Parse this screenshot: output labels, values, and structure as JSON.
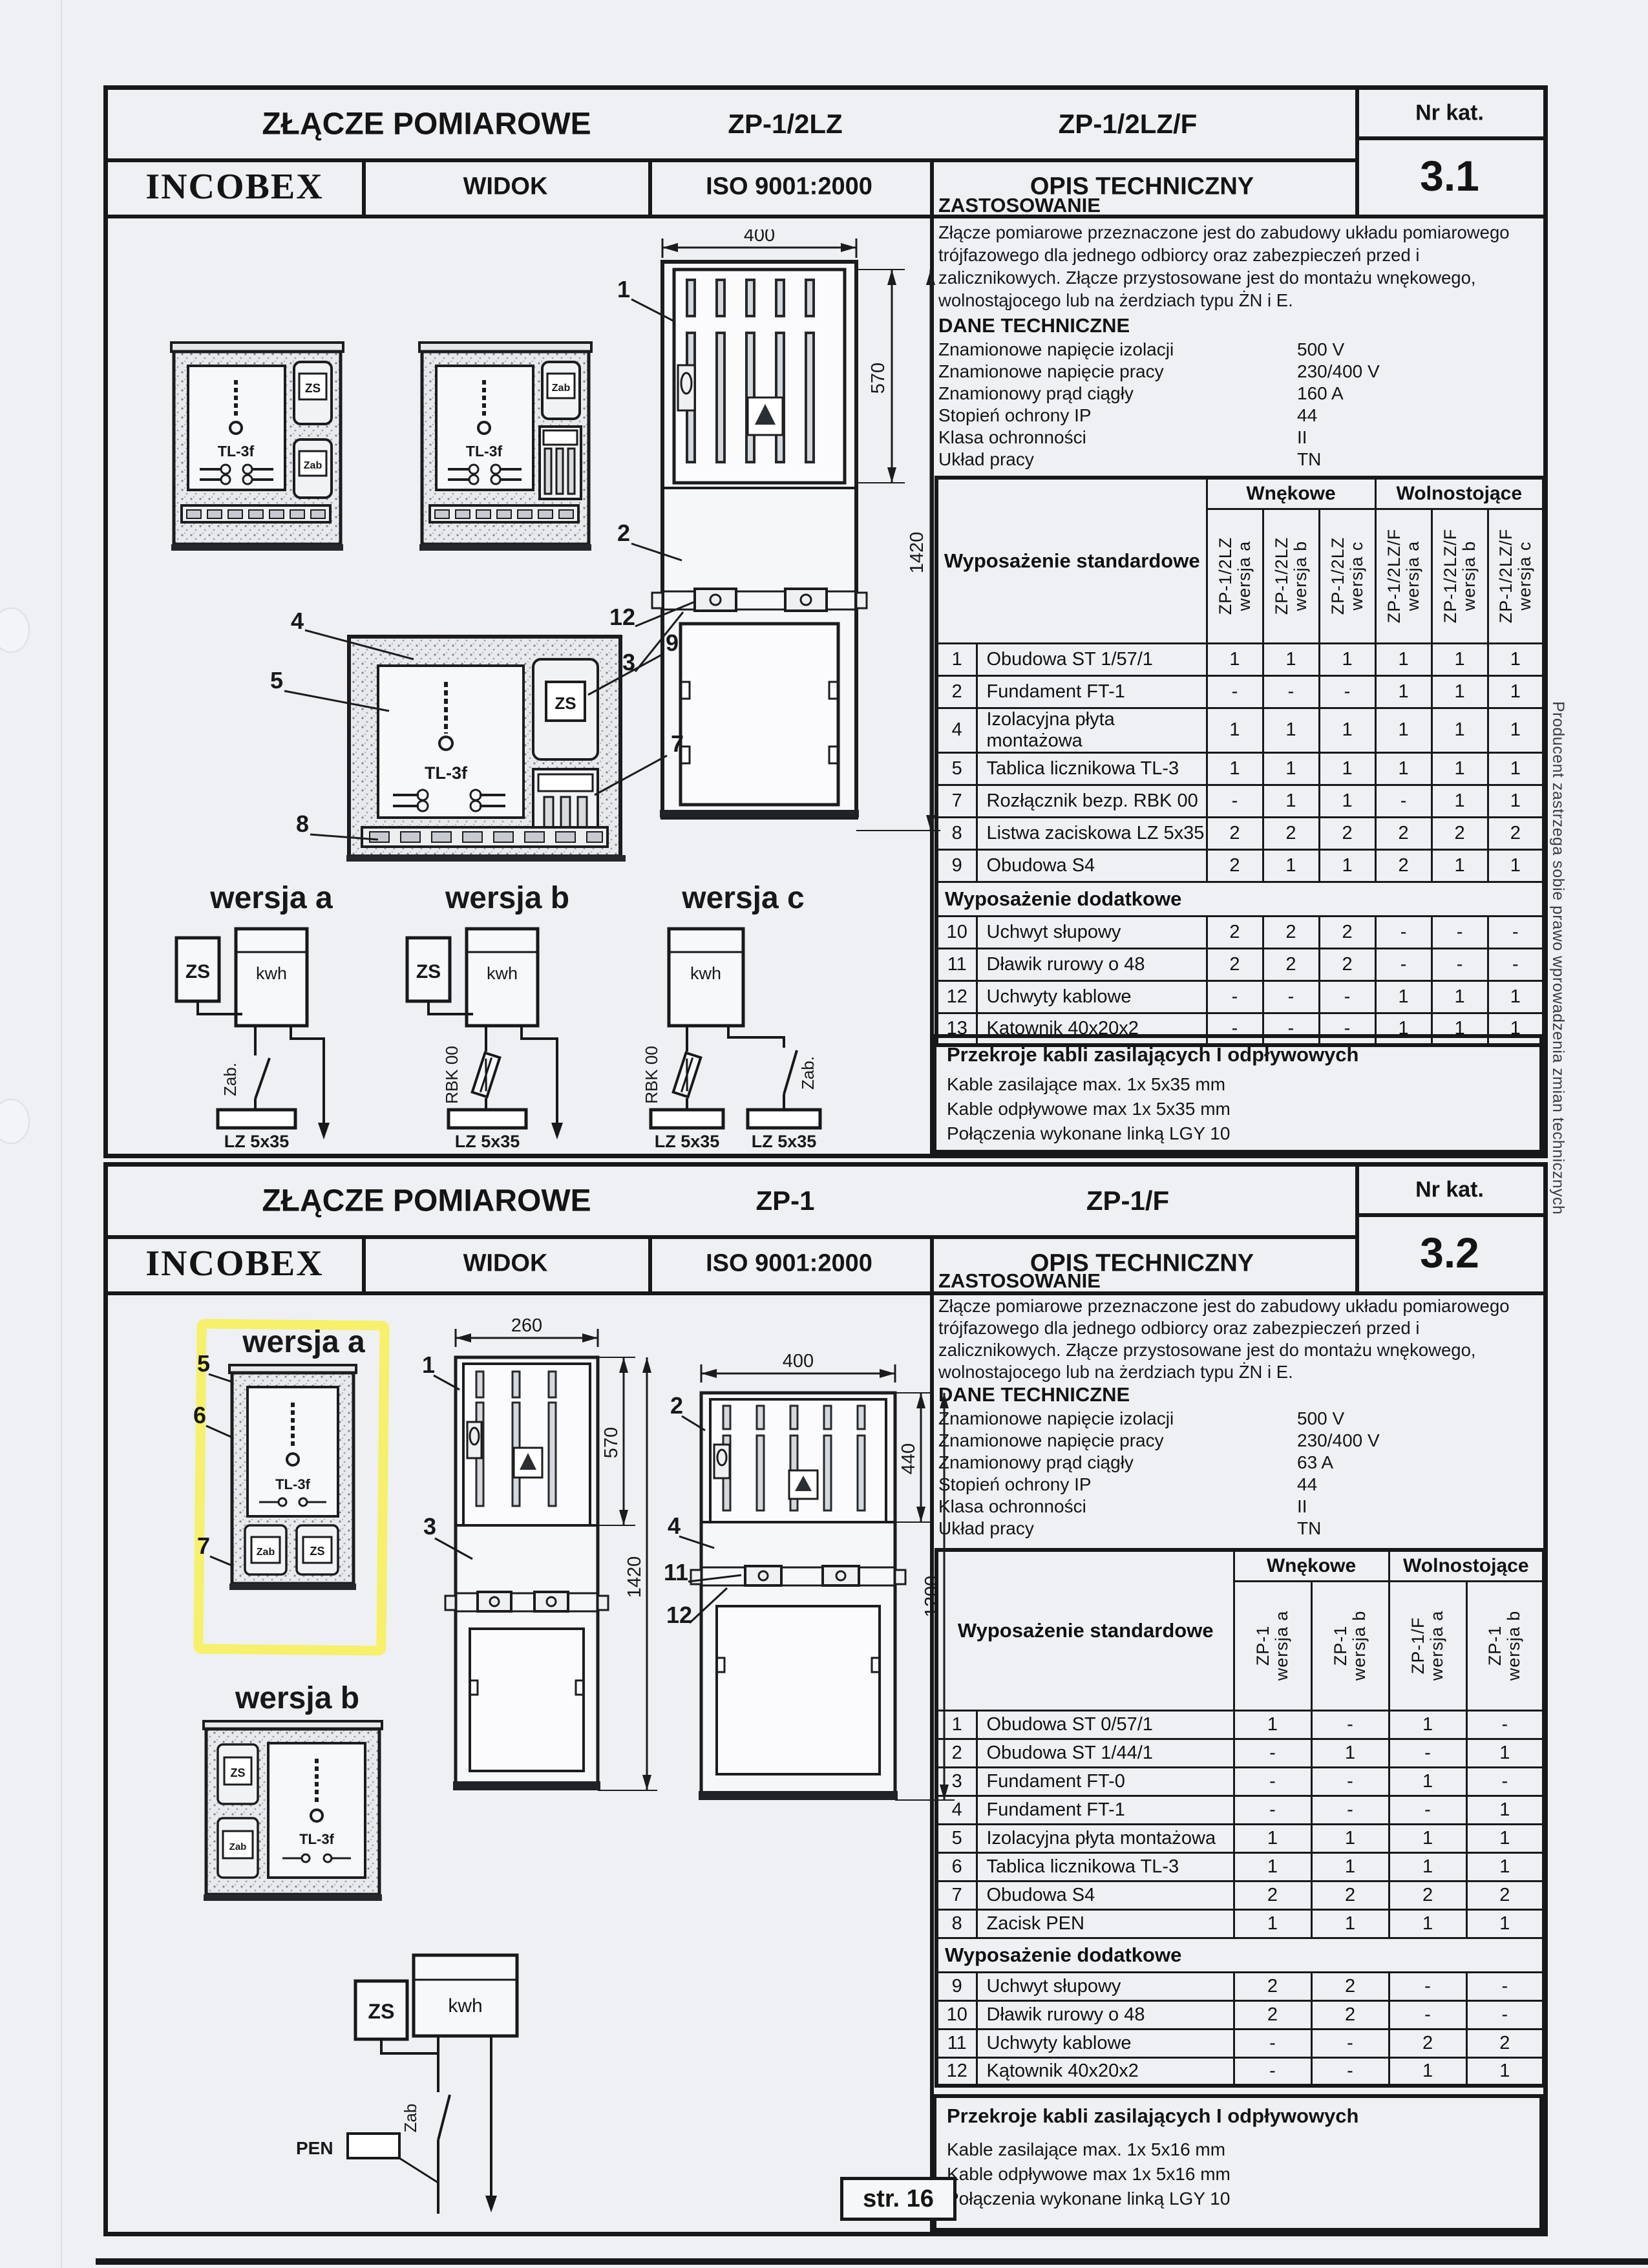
{
  "scan": {
    "page_label": "str. 16",
    "margin_note": "Producent zastrzega sobie prawo wprowadzenia zmian technicznych"
  },
  "s1": {
    "title": "ZŁĄCZE POMIAROWE",
    "model_a": "ZP-1/2LZ",
    "model_b": "ZP-1/2LZ/F",
    "nr_kat_label": "Nr kat.",
    "nr_kat": "3.1",
    "brand": "INCOBEX",
    "view_label": "WIDOK",
    "iso_label": "ISO 9001:2000",
    "desc_label": "OPIS TECHNICZNY",
    "zastosowanie_title": "ZASTOSOWANIE",
    "zastosowanie": "Złącze pomiarowe przeznaczone jest do zabudowy układu pomiarowego trójfazowego dla jednego odbiorcy oraz zabezpieczeń przed i zalicznikowych. Złącze przystosowane jest do montażu wnękowego, wolnostąjocego lub  na żerdziach typu ŻN i E.",
    "dane_title": "DANE TECHNICZNE",
    "dane": [
      [
        "Znamionowe napięcie izolacji",
        "500 V"
      ],
      [
        "Znamionowe napięcie pracy",
        "230/400 V"
      ],
      [
        "Znamionowy prąd ciągły",
        "160 A"
      ],
      [
        "Stopień ochrony IP",
        "44"
      ],
      [
        "Klasa ochronności",
        "II"
      ],
      [
        "Układ pracy",
        "TN"
      ]
    ],
    "table": {
      "header": "Wyposażenie standardowe",
      "group1": "Wnękowe",
      "group2": "Wolnostojące",
      "cols": [
        {
          "model": "ZP-1/2LZ",
          "ver": "wersja a"
        },
        {
          "model": "ZP-1/2LZ",
          "ver": "wersja b"
        },
        {
          "model": "ZP-1/2LZ",
          "ver": "wersja c"
        },
        {
          "model": "ZP-1/2LZ/F",
          "ver": "wersja a"
        },
        {
          "model": "ZP-1/2LZ/F",
          "ver": "wersja b"
        },
        {
          "model": "ZP-1/2LZ/F",
          "ver": "wersja c"
        }
      ],
      "rows": [
        [
          "1",
          "Obudowa ST 1/57/1",
          "1",
          "1",
          "1",
          "1",
          "1",
          "1"
        ],
        [
          "2",
          "Fundament FT-1",
          "-",
          "-",
          "-",
          "1",
          "1",
          "1"
        ],
        [
          "4",
          "Izolacyjna płyta montażowa",
          "1",
          "1",
          "1",
          "1",
          "1",
          "1"
        ],
        [
          "5",
          "Tablica licznikowa TL-3",
          "1",
          "1",
          "1",
          "1",
          "1",
          "1"
        ],
        [
          "7",
          "Rozłącznik bezp. RBK 00",
          "-",
          "1",
          "1",
          "-",
          "1",
          "1"
        ],
        [
          "8",
          "Listwa zaciskowa LZ 5x35",
          "2",
          "2",
          "2",
          "2",
          "2",
          "2"
        ],
        [
          "9",
          "Obudowa S4",
          "2",
          "1",
          "1",
          "2",
          "1",
          "1"
        ]
      ],
      "extra_header": "Wyposażenie dodatkowe",
      "extra_rows": [
        [
          "10",
          "Uchwyt słupowy",
          "2",
          "2",
          "2",
          "-",
          "-",
          "-"
        ],
        [
          "11",
          "Dławik rurowy o 48",
          "2",
          "2",
          "2",
          "-",
          "-",
          "-"
        ],
        [
          "12",
          "Uchwyty kablowe",
          "-",
          "-",
          "-",
          "1",
          "1",
          "1"
        ],
        [
          "13",
          "Kątownik 40x20x2",
          "-",
          "-",
          "-",
          "1",
          "1",
          "1"
        ]
      ]
    },
    "cables_title": "Przekroje kabli zasilających I odpływowych",
    "cables": [
      "Kable zasilające max. 1x 5x35 mm",
      "Kable odpływowe max 1x 5x35 mm",
      "Połączenia wykonane linką LGY 10"
    ],
    "drawing": {
      "dim_w": "400",
      "dim_door": "570",
      "dim_h": "1420",
      "tl": "TL-3f",
      "zs": "ZS",
      "zab": "Zab",
      "callouts": {
        "n1": "1",
        "n2": "2",
        "n4": "4",
        "n5": "5",
        "n7": "7",
        "n8": "8",
        "n9": "9",
        "n12": "12",
        "n13": "13"
      },
      "versions": [
        {
          "label": "wersja a",
          "zs": "ZS",
          "kwh": "kwh",
          "dev": "Zab.",
          "bar": "LZ 5x35"
        },
        {
          "label": "wersja b",
          "zs": "ZS",
          "kwh": "kwh",
          "dev": "RBK 00",
          "bar": "LZ 5x35"
        },
        {
          "label": "wersja c",
          "kwh": "kwh",
          "dev": "RBK 00",
          "dev2": "Zab.",
          "bar": "LZ 5x35",
          "bar2": "LZ 5x35"
        }
      ]
    }
  },
  "s2": {
    "title": "ZŁĄCZE POMIAROWE",
    "model_a": "ZP-1",
    "model_b": "ZP-1/F",
    "nr_kat_label": "Nr kat.",
    "nr_kat": "3.2",
    "brand": "INCOBEX",
    "view_label": "WIDOK",
    "iso_label": "ISO 9001:2000",
    "desc_label": "OPIS TECHNICZNY",
    "zastosowanie_title": "ZASTOSOWANIE",
    "zastosowanie": "Złącze pomiarowe przeznaczone jest do zabudowy układu pomiarowego trójfazowego dla jednego odbiorcy oraz zabezpieczeń przed i zalicznikowych. Złącze przystosowane jest do montażu wnękowego, wolnostajocego lub  na żerdziach typu ŻN i E.",
    "dane_title": "DANE TECHNICZNE",
    "dane": [
      [
        "Znamionowe napięcie izolacji",
        "500 V"
      ],
      [
        "Znamionowe napięcie pracy",
        "230/400 V"
      ],
      [
        "Znamionowy prąd ciągły",
        "63 A"
      ],
      [
        "Stopień ochrony IP",
        "44"
      ],
      [
        "Klasa ochronności",
        "II"
      ],
      [
        "Układ pracy",
        "TN"
      ]
    ],
    "table": {
      "header": "Wyposażenie standardowe",
      "group1": "Wnękowe",
      "group2": "Wolnostojące",
      "cols": [
        {
          "model": "ZP-1",
          "ver": "wersja a"
        },
        {
          "model": "ZP-1",
          "ver": "wersja b"
        },
        {
          "model": "ZP-1/F",
          "ver": "wersja a"
        },
        {
          "model": "ZP-1",
          "ver": "wersja b"
        }
      ],
      "rows": [
        [
          "1",
          "Obudowa ST 0/57/1",
          "1",
          "-",
          "1",
          "-"
        ],
        [
          "2",
          "Obudowa ST 1/44/1",
          "-",
          "1",
          "-",
          "1"
        ],
        [
          "3",
          "Fundament FT-0",
          "-",
          "-",
          "1",
          "-"
        ],
        [
          "4",
          "Fundament FT-1",
          "-",
          "-",
          "-",
          "1"
        ],
        [
          "5",
          "Izolacyjna płyta montażowa",
          "1",
          "1",
          "1",
          "1"
        ],
        [
          "6",
          "Tablica licznikowa TL-3",
          "1",
          "1",
          "1",
          "1"
        ],
        [
          "7",
          "Obudowa S4",
          "2",
          "2",
          "2",
          "2"
        ],
        [
          "8",
          "Zacisk PEN",
          "1",
          "1",
          "1",
          "1"
        ]
      ],
      "extra_header": "Wyposażenie dodatkowe",
      "extra_rows": [
        [
          "9",
          "Uchwyt słupowy",
          "2",
          "2",
          "-",
          "-"
        ],
        [
          "10",
          "Dławik rurowy o 48",
          "2",
          "2",
          "-",
          "-"
        ],
        [
          "11",
          "Uchwyty kablowe",
          "-",
          "-",
          "2",
          "2"
        ],
        [
          "12",
          "Kątownik 40x20x2",
          "-",
          "-",
          "1",
          "1"
        ]
      ]
    },
    "cables_title": "Przekroje kabli zasilających I odpływowych",
    "cables": [
      "Kable zasilające max. 1x 5x16 mm",
      "Kable odpływowe max 1x 5x16 mm",
      "Połączenia wykonane linką LGY 10"
    ],
    "drawing": {
      "dims": {
        "w1": "260",
        "w2": "400",
        "door1": "570",
        "door2": "440",
        "h1": "1420",
        "h2": "1200"
      },
      "tl": "TL-3f",
      "zs": "ZS",
      "zab": "Zab",
      "pen": "PEN",
      "kwh": "kwh",
      "zab_dev": "Zab",
      "callouts": {
        "n1": "1",
        "n2": "2",
        "n3": "3",
        "n4": "4",
        "n5": "5",
        "n6": "6",
        "n7": "7",
        "n11": "11",
        "n12": "12"
      },
      "versions": [
        {
          "label": "wersja a"
        },
        {
          "label": "wersja b"
        }
      ]
    }
  }
}
